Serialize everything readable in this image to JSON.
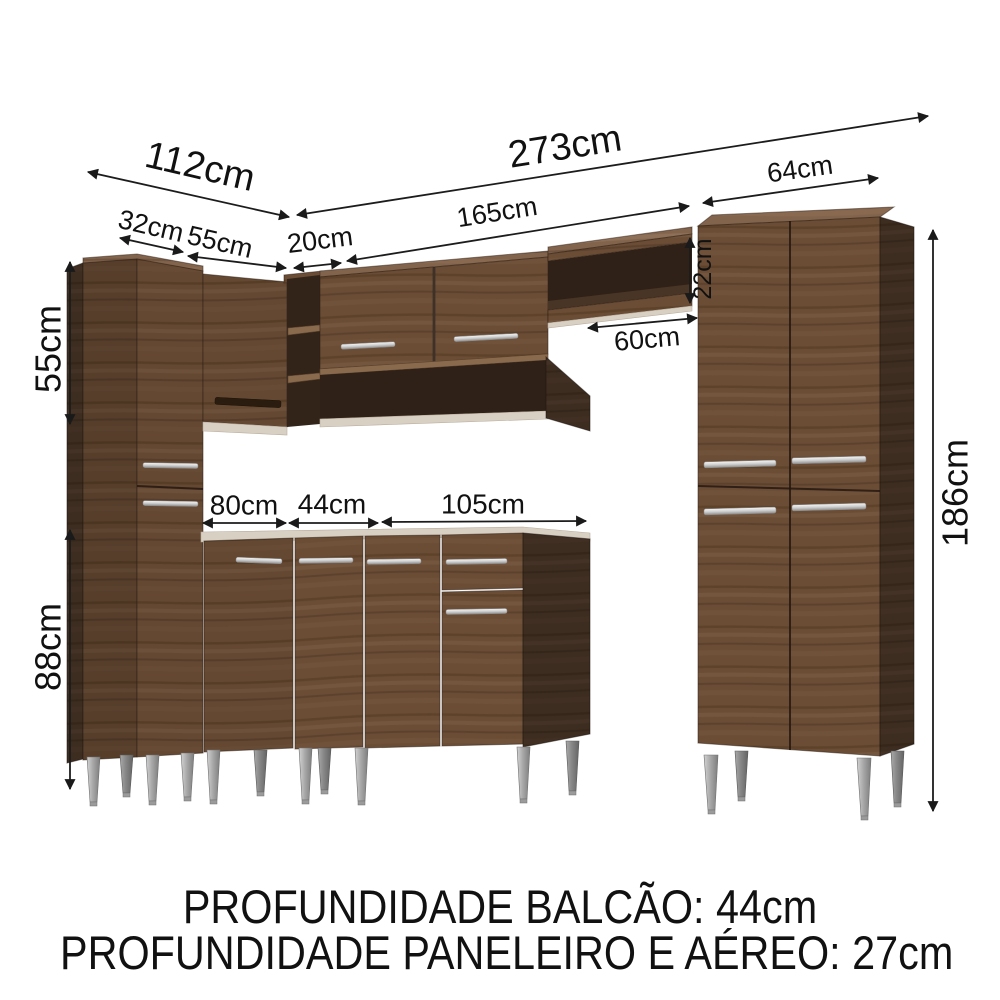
{
  "diagram_type": "kitchen-cabinet-dimension-diagram",
  "dimensions": {
    "left_wall_total": "112cm",
    "main_wall_total": "273cm",
    "left_segment_1": "32cm",
    "left_segment_2": "55cm",
    "left_segment_3": "20cm",
    "aereo_width": "165cm",
    "paneleiro_width": "64cm",
    "shelf_opening_height": "22cm",
    "niche_width": "60cm",
    "upper_cabinet_height": "55cm",
    "base_cabinet_height": "88cm",
    "paneleiro_height": "186cm",
    "balcao_segment_1": "80cm",
    "balcao_segment_2": "44cm",
    "balcao_segment_3": "105cm"
  },
  "footer": {
    "line1": "PROFUNDIDADE BALCÃO: 44cm",
    "line2": "PROFUNDIDADE PANELEIRO E AÉREO: 27cm"
  },
  "colors": {
    "wood": "#6b4d36",
    "wood_dark": "#3e2c1f",
    "interior": "#2f2117",
    "light_edge": "#d9d0c4",
    "handle_silver": "#c9c9c9",
    "leg_silver": "#a8a8a8",
    "dimension_text": "#111111",
    "background": "#ffffff"
  }
}
